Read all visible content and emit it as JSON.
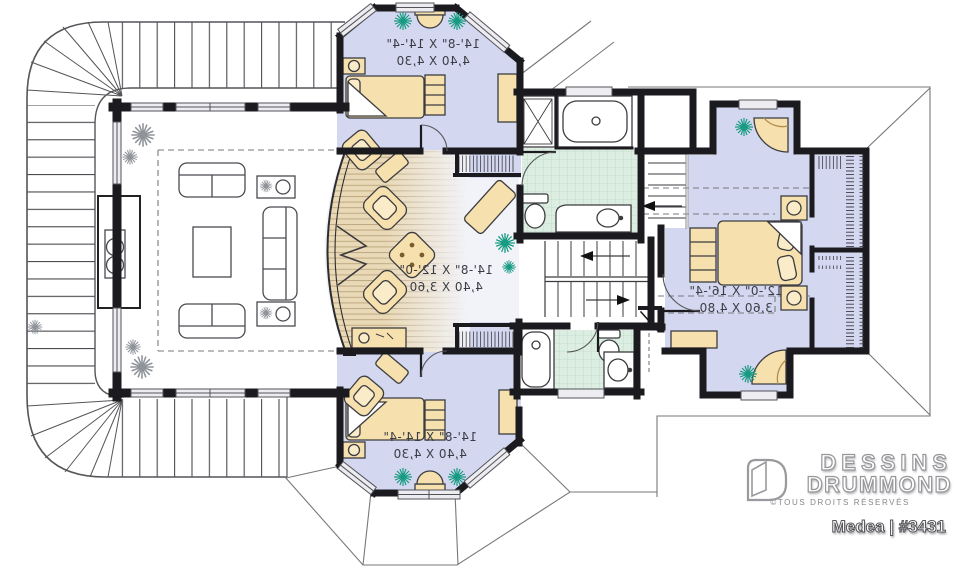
{
  "plan": {
    "title": "Medea | #3431"
  },
  "brand": {
    "name_line1": "DESSINS",
    "name_line2": "DRUMMOND",
    "copyright": "©TOUS DROITS RÉSERVÉS"
  },
  "rooms": {
    "bedroom_top": {
      "dim_imperial": "14'-8\" X 14'-4\"",
      "dim_metric": "4,40 X 4,30"
    },
    "family_room": {
      "dim_imperial": "14'-8\" X 12'-0\"",
      "dim_metric": "4,40 X 3,60"
    },
    "bedroom_bottom": {
      "dim_imperial": "14'-8\" X 14'-4\"",
      "dim_metric": "4,40 X 4,30"
    },
    "master_bedroom": {
      "dim_imperial": "12'-0\" X 16'-4\"",
      "dim_metric": "3,60 X 4,80"
    }
  },
  "colors": {
    "wall": "#1b1b1f",
    "bedroom_floor": "#d3d7ef",
    "family_floor": "#f2f3f9",
    "tile_floor": "#dcede2",
    "wood_floor": "#e9d9b6",
    "furniture": "#f6e0ae",
    "plant_green": "#169a82",
    "plant_gray": "#8f939a",
    "line_gray": "#55555a"
  }
}
